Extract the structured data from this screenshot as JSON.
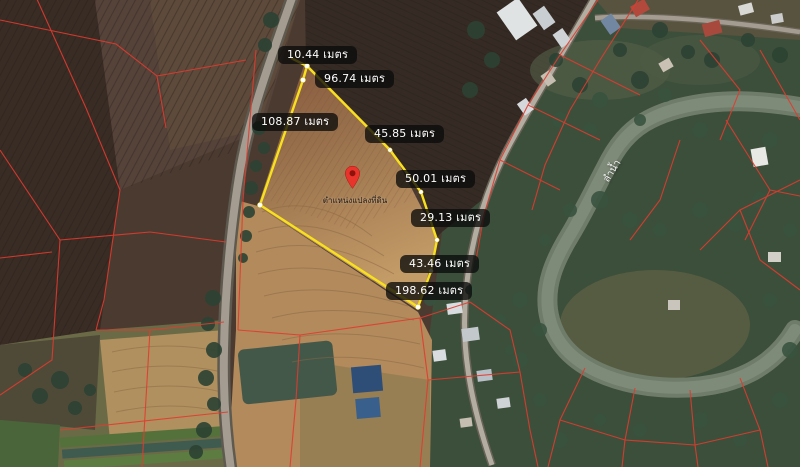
{
  "map": {
    "unit": "เมตร",
    "pin": {
      "label": "ตำแหน่งแปลงที่ดิน"
    },
    "river": {
      "label": "ลำน้ำ"
    },
    "measurements": [
      {
        "value": "10.44",
        "label": "10.44 เมตร"
      },
      {
        "value": "96.74",
        "label": "96.74 เมตร"
      },
      {
        "value": "108.87",
        "label": "108.87 เมตร"
      },
      {
        "value": "45.85",
        "label": "45.85 เมตร"
      },
      {
        "value": "50.01",
        "label": "50.01 เมตร"
      },
      {
        "value": "29.13",
        "label": "29.13 เมตร"
      },
      {
        "value": "43.46",
        "label": "43.46 เมตร"
      },
      {
        "value": "198.62",
        "label": "198.62 เมตร"
      }
    ],
    "colors": {
      "boundary_yellow": "#f8e11c",
      "label_bg": "rgba(12,12,12,0.78)",
      "label_text": "#ffffff",
      "pin_red": "#e8342b",
      "cadastral_red": "#e23b2e"
    }
  }
}
